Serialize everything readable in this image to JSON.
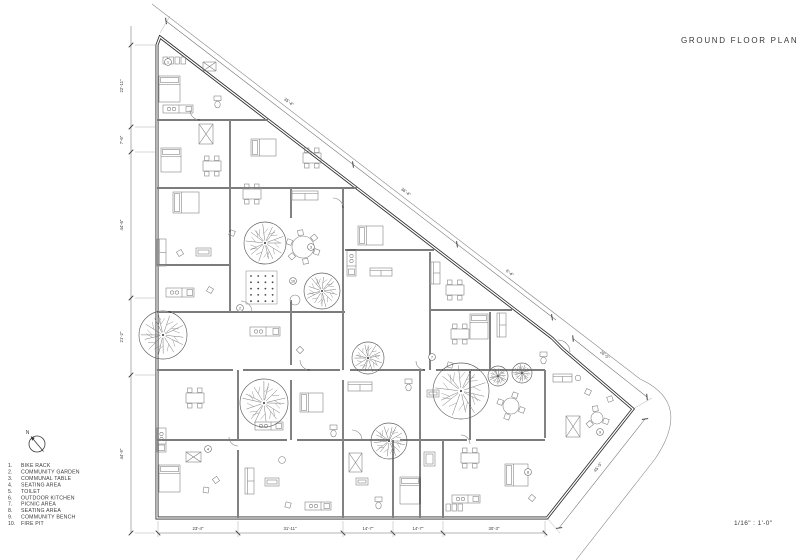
{
  "title": "GROUND FLOOR PLAN",
  "scale_label": "1/16\" : 1'-0\"",
  "north_label": "N",
  "colors": {
    "wall": "#2e2e2e",
    "thin_line": "#777777",
    "text": "#3a3a3a"
  },
  "legend": [
    {
      "num": "1.",
      "label": "BIKE RACK"
    },
    {
      "num": "2.",
      "label": "COMMUNITY GARDEN"
    },
    {
      "num": "3.",
      "label": "COMMUNAL TABLE"
    },
    {
      "num": "4.",
      "label": "SEATING AREA"
    },
    {
      "num": "5.",
      "label": "TOILET"
    },
    {
      "num": "6.",
      "label": "OUTDOOR KITCHEN"
    },
    {
      "num": "7.",
      "label": "PICNIC AREA"
    },
    {
      "num": "8.",
      "label": "SEATING AREA"
    },
    {
      "num": "9.",
      "label": "COMMUNITY BENCH"
    },
    {
      "num": "10.",
      "label": "FIRE PIT"
    }
  ],
  "dimensions": {
    "left": [
      {
        "text": "22'-11\"",
        "x": 123,
        "y": 86
      },
      {
        "text": "7'-6\"",
        "x": 123,
        "y": 140
      },
      {
        "text": "44'-6\"",
        "x": 123,
        "y": 225
      },
      {
        "text": "21'-2\"",
        "x": 123,
        "y": 337
      },
      {
        "text": "44'-9\"",
        "x": 123,
        "y": 454
      }
    ],
    "bottom": [
      {
        "text": "23'-4\"",
        "x": 198,
        "y": 530
      },
      {
        "text": "31'-11\"",
        "x": 290,
        "y": 530
      },
      {
        "text": "14'-7\"",
        "x": 368,
        "y": 530
      },
      {
        "text": "14'-7\"",
        "x": 418,
        "y": 530
      },
      {
        "text": "30'-3\"",
        "x": 494,
        "y": 530
      }
    ],
    "diagonal": [
      {
        "text": "35'-4\"",
        "x": 288,
        "y": 103,
        "rot": 37.5
      },
      {
        "text": "36'-4\"",
        "x": 405,
        "y": 193,
        "rot": 37.5
      },
      {
        "text": "6'-4\"",
        "x": 509,
        "y": 274,
        "rot": 37.5
      },
      {
        "text": "26'-5\"",
        "x": 604,
        "y": 356,
        "rot": 40
      },
      {
        "text": "45'-5\"",
        "x": 599,
        "y": 468,
        "rot": -52
      }
    ]
  }
}
